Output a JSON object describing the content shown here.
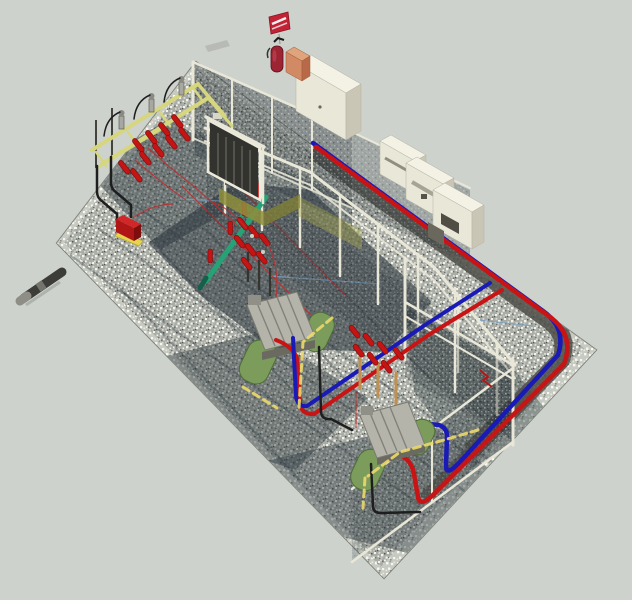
{
  "meta": {
    "width": 632,
    "height": 600,
    "description": "3D rendered axonometric view of an electrical substation yard: gravel pad with chain-link fences, yellow takeoff gantry with red bushings, two green pad transformers with gray radiators, red and blue power cables in a perimeter trench, cream control cabinets along the far edge, fire extinguisher with red flag, and a gray conduit stub leaving the pad"
  },
  "palette": {
    "background": "#cdd2cd",
    "gravel_base": "#a9ada5",
    "gravel_light": "#c6cac1",
    "shadow": "#2e3940",
    "trench_dark": "#4c4c46",
    "mesh_dark": "#2c343a",
    "frame_cream": "#e9e7d8",
    "cabinet_front": "#e9e7d8",
    "cabinet_side": "#c9c6b5",
    "cabinet_top": "#f4f2e5",
    "gantry_yellow": "#d6d67e",
    "insulator_red": "#c41414",
    "cable_red": "#c81414",
    "cable_blue": "#1a1ab6",
    "busbar_teal": "#26a376",
    "busbar_teal_dark": "#156048",
    "transformer_green": "#7c9c5c",
    "transformer_green_dark": "#4d6e38",
    "radiator_gray": "#b4b4aa",
    "equipment_dark": "#32322e",
    "olive_wall": "#8f8f3c",
    "conduit_yellow": "#ecd96a",
    "wire_red_thin": "#b83030",
    "wire_blue_thin": "#7aa0c0",
    "extinguisher_red": "#9c2433",
    "flag_red": "#c22233",
    "crate_orange": "#d28a64",
    "pipe_dark": "#3c3c38",
    "pipe_cap": "#8e8e86",
    "post_tan": "#c09050",
    "base_yellow": "#e6d44c",
    "insulator_gray": "#a8a8a0"
  }
}
